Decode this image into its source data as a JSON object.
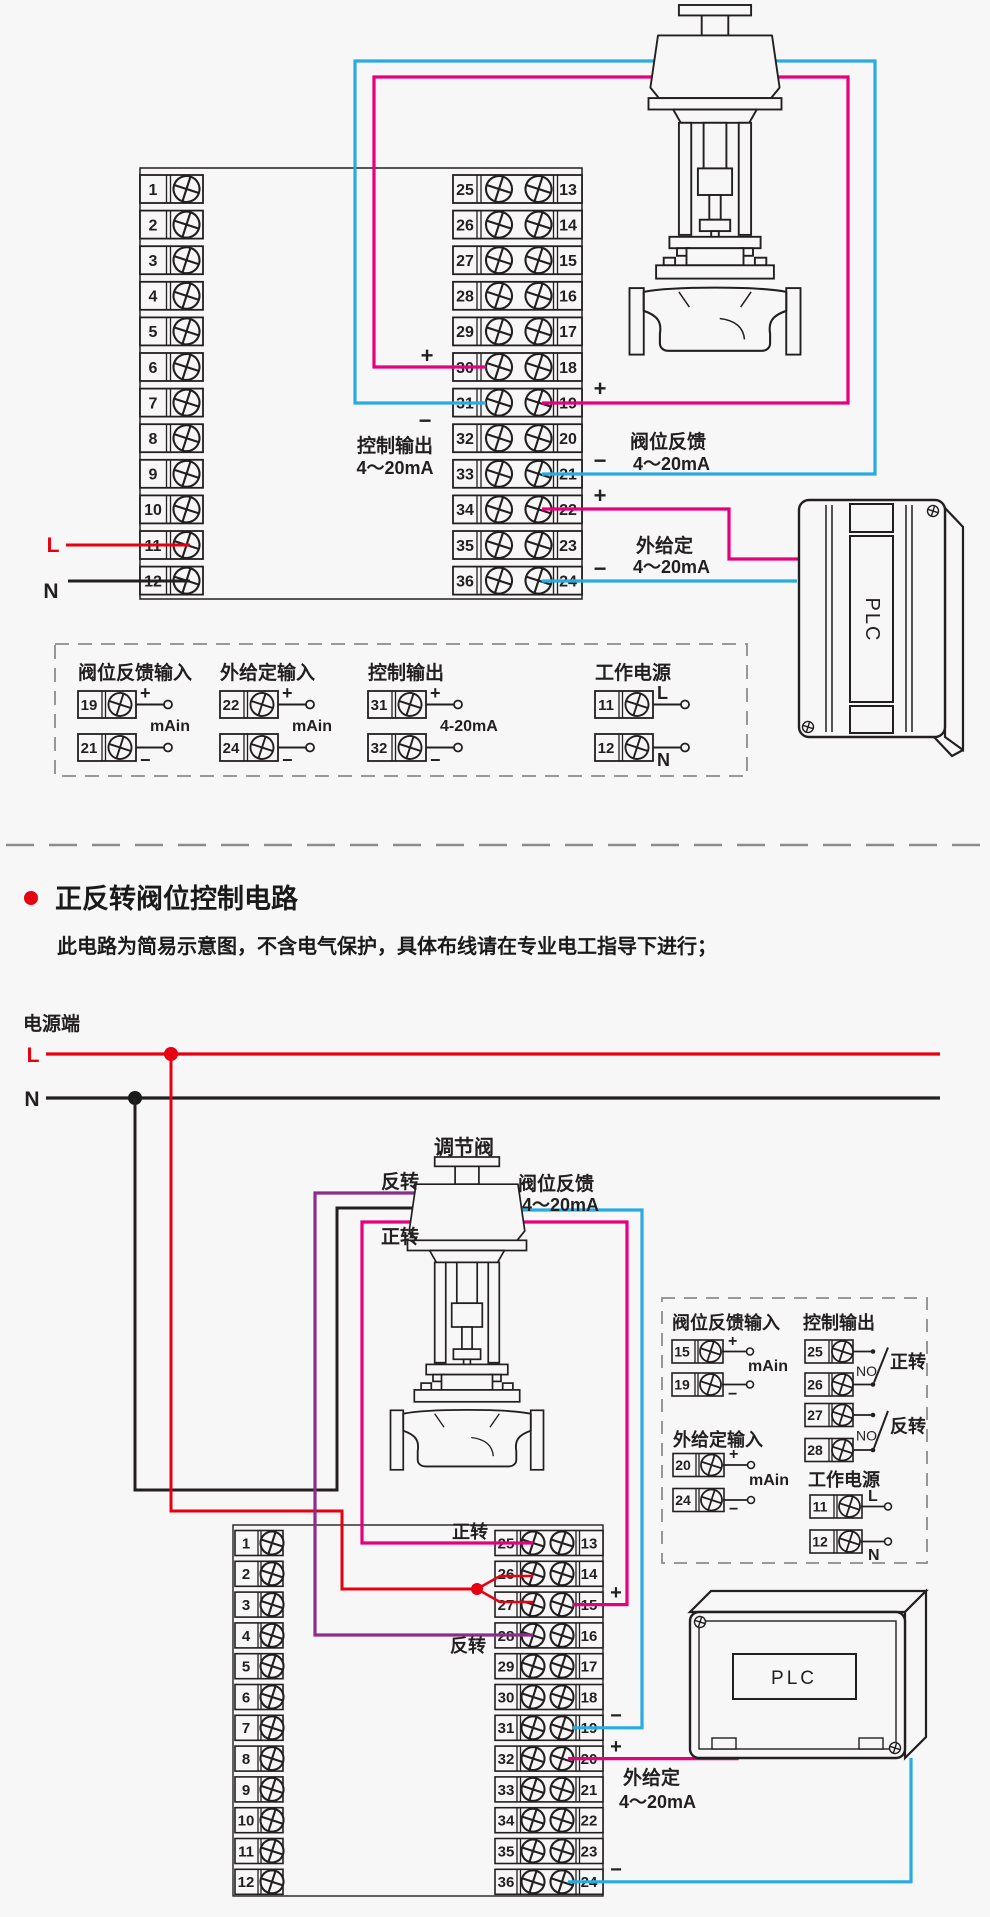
{
  "colors": {
    "red": "#e60012",
    "magenta": "#e6007e",
    "blue": "#29abe2",
    "purple": "#8b2d8b",
    "line": "#231f20",
    "dash": "#8c8c8c",
    "bg": "#f7f7f7"
  },
  "d1": {
    "left_numbers": [
      "1",
      "2",
      "3",
      "4",
      "5",
      "6",
      "7",
      "8",
      "9",
      "10",
      "11",
      "12"
    ],
    "mid_left_numbers": [
      "25",
      "26",
      "27",
      "28",
      "29",
      "30",
      "31",
      "32",
      "33",
      "34",
      "35",
      "36"
    ],
    "mid_right_numbers": [
      "13",
      "14",
      "15",
      "16",
      "17",
      "18",
      "19",
      "20",
      "21",
      "22",
      "23",
      "24"
    ],
    "plus": "+",
    "minus": "−",
    "control_output": [
      "控制输出",
      "4～20mA"
    ],
    "valve_feedback": [
      "阀位反馈",
      "4～20mA"
    ],
    "ext_setpoint": [
      "外给定",
      "4～20mA"
    ],
    "l_label": "L",
    "n_label": "N",
    "plc_label": "PLC",
    "legend_groups": [
      {
        "title": "阀位反馈输入",
        "top_num": "19",
        "bot_num": "21",
        "top_sym": "+",
        "bot_sym": "−",
        "mid": "mAin"
      },
      {
        "title": "外给定输入",
        "top_num": "22",
        "bot_num": "24",
        "top_sym": "+",
        "bot_sym": "−",
        "mid": "mAin"
      },
      {
        "title": "控制输出",
        "top_num": "31",
        "bot_num": "32",
        "top_sym": "+",
        "bot_sym": "−",
        "mid": "4-20mA"
      },
      {
        "title": "工作电源",
        "top_num": "11",
        "bot_num": "12",
        "top_sym": "L",
        "bot_sym": "N",
        "mid": ""
      }
    ]
  },
  "section2": {
    "title": "正反转阀位控制电路",
    "subtitle": "此电路为简易示意图，不含电气保护，具体布线请在专业电工指导下进行；"
  },
  "d2": {
    "power_title": "电源端",
    "l_label": "L",
    "n_label": "N",
    "valve_title": "调节阀",
    "reverse": "反转",
    "forward": "正转",
    "feedback": [
      "阀位反馈",
      "4～20mA"
    ],
    "ext": [
      "外给定",
      "4～20mA"
    ],
    "plus": "+",
    "minus": "−",
    "plc_label": "PLC",
    "left_numbers": [
      "1",
      "2",
      "3",
      "4",
      "5",
      "6",
      "7",
      "8",
      "9",
      "10",
      "11",
      "12"
    ],
    "mid_left_numbers": [
      "25",
      "26",
      "27",
      "28",
      "29",
      "30",
      "31",
      "32",
      "33",
      "34",
      "35",
      "36"
    ],
    "mid_right_numbers": [
      "13",
      "14",
      "15",
      "16",
      "17",
      "18",
      "19",
      "20",
      "21",
      "22",
      "23",
      "24"
    ],
    "legend": {
      "fb_title": "阀位反馈输入",
      "fb_top": "15",
      "fb_bot": "19",
      "fb_mid": "mAin",
      "ext_title": "外给定输入",
      "ext_top": "20",
      "ext_bot": "24",
      "ext_mid": "mAin",
      "ctrl_title": "控制输出",
      "r1_top": "25",
      "r1_bot": "26",
      "r1_no": "NO",
      "r1_label": "正转",
      "r2_top": "27",
      "r2_bot": "28",
      "r2_no": "NO",
      "r2_label": "反转",
      "pwr_title": "工作电源",
      "pwr_top": "11",
      "pwr_bot": "12",
      "pwr_l": "L",
      "pwr_n": "N"
    }
  }
}
